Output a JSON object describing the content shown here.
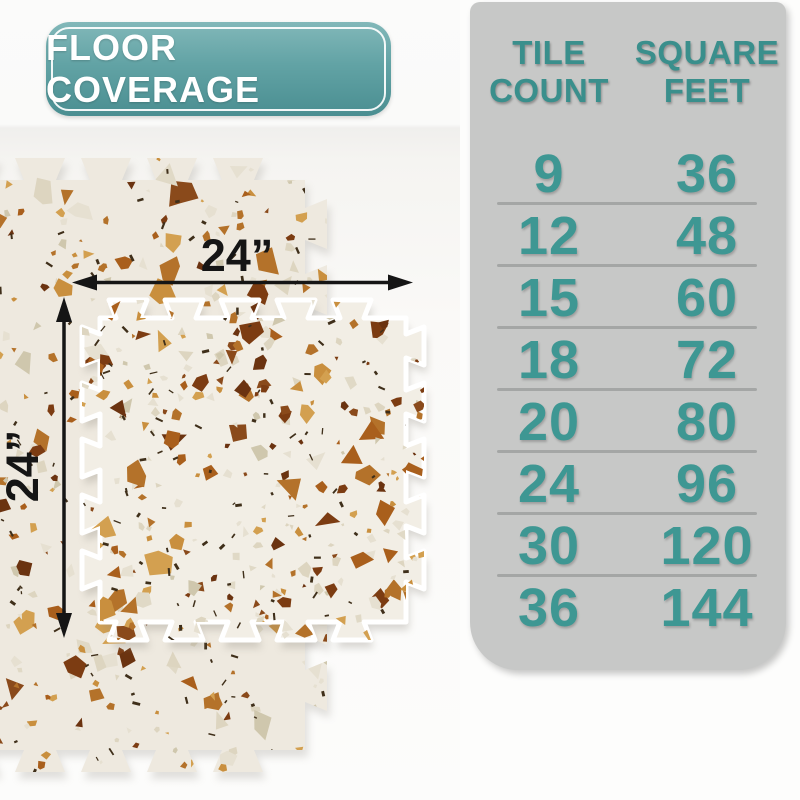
{
  "badge": {
    "label": "FLOOR COVERAGE"
  },
  "diagram": {
    "width_label": "24”",
    "height_label": "24”",
    "tile_style": "terrazzo interlocking foam tiles"
  },
  "table": {
    "col1_header": "TILE\nCOUNT",
    "col2_header": "SQUARE\nFEET",
    "rows": [
      {
        "tile_count": "9",
        "square_feet": "36"
      },
      {
        "tile_count": "12",
        "square_feet": "48"
      },
      {
        "tile_count": "15",
        "square_feet": "60"
      },
      {
        "tile_count": "18",
        "square_feet": "72"
      },
      {
        "tile_count": "20",
        "square_feet": "80"
      },
      {
        "tile_count": "24",
        "square_feet": "96"
      },
      {
        "tile_count": "30",
        "square_feet": "120"
      },
      {
        "tile_count": "36",
        "square_feet": "144"
      }
    ]
  },
  "chart_data": {
    "type": "table",
    "title": "FLOOR COVERAGE",
    "columns": [
      "TILE COUNT",
      "SQUARE FEET"
    ],
    "tile_count": [
      9,
      12,
      15,
      18,
      20,
      24,
      30,
      36
    ],
    "square_feet": [
      36,
      48,
      60,
      72,
      80,
      96,
      120,
      144
    ]
  },
  "colors": {
    "teal_text": "#3e9793",
    "badge_teal_top": "#82b8b9",
    "badge_teal_bottom": "#4a8e91",
    "panel_gray": "#c7c8c7",
    "divider_gray": "#a4a6a5",
    "arrow_black": "#151515",
    "tile_cream": "#f2eee5"
  }
}
